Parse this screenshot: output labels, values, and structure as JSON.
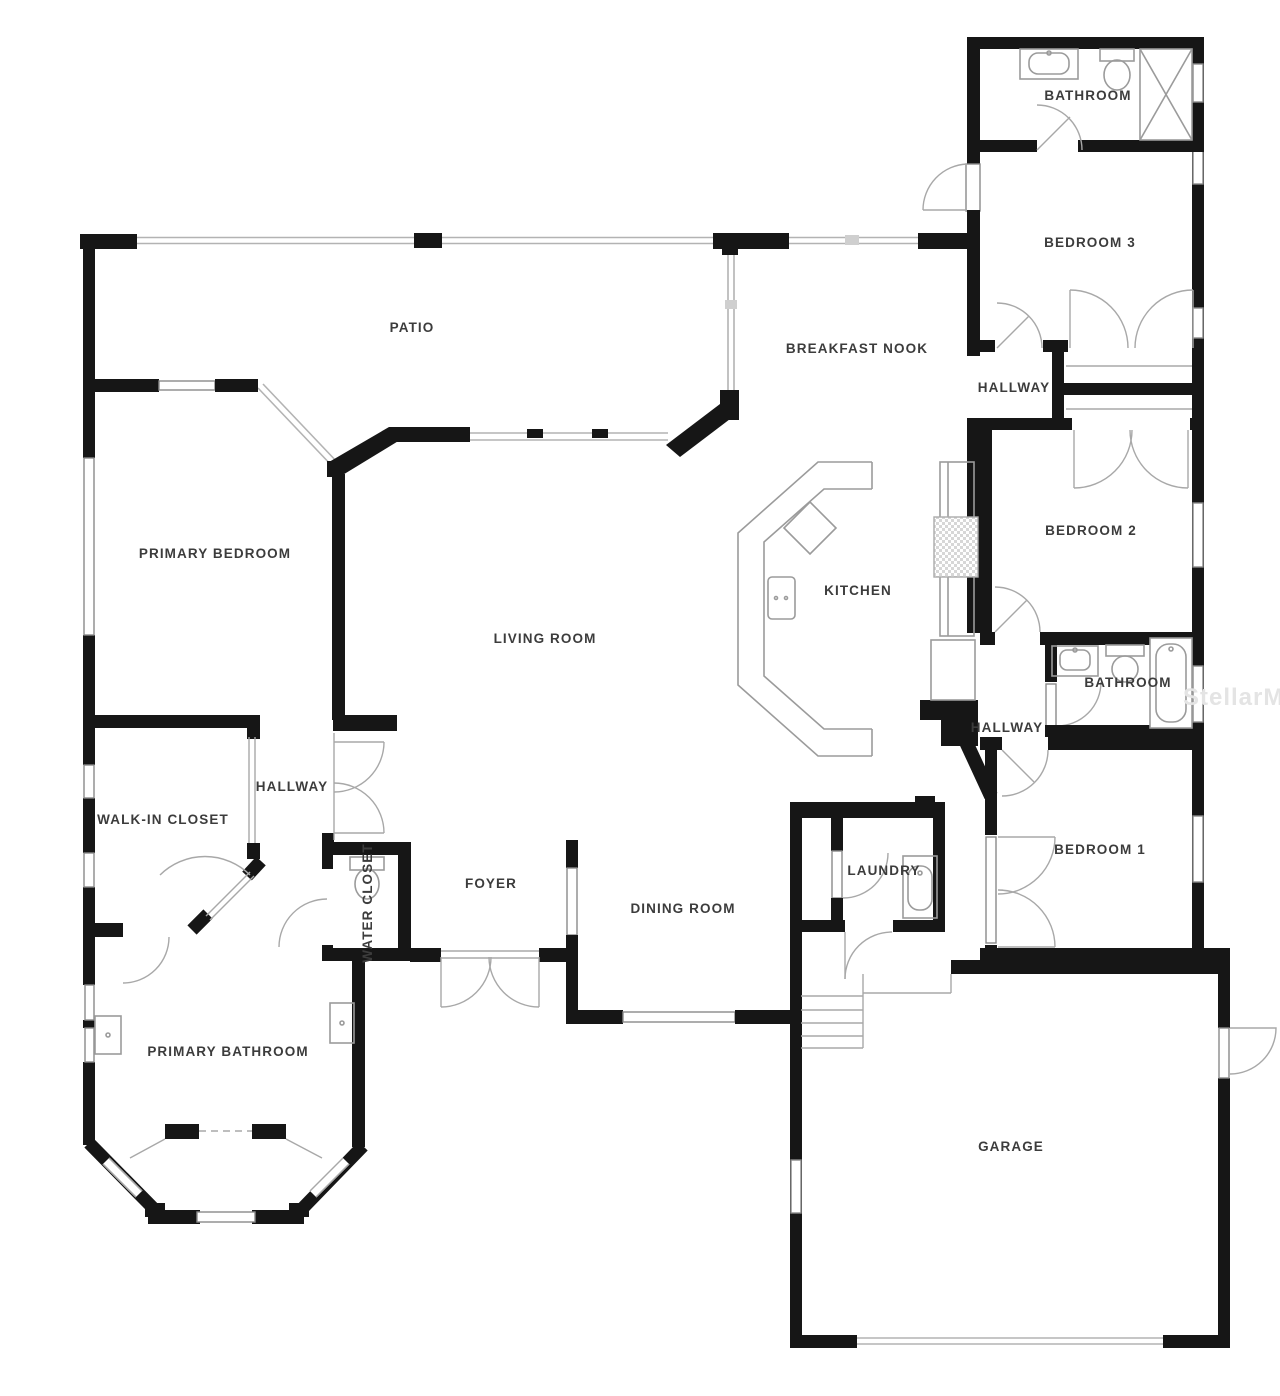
{
  "watermark": "StellarMLS",
  "colors": {
    "wall": "#161616",
    "fixture_line": "#9b9b9b",
    "screen_line": "#b3b3b3",
    "label_text": "#3c3c3c",
    "watermark_text": "#e4e4e4",
    "background": "#ffffff"
  },
  "rooms": {
    "patio": "PATIO",
    "breakfast_nook": "BREAKFAST NOOK",
    "bathroom_top": "BATHROOM",
    "bedroom3": "BEDROOM 3",
    "hallway_upper": "HALLWAY",
    "bedroom2": "BEDROOM 2",
    "bathroom_right": "BATHROOM",
    "hallway_lower": "HALLWAY",
    "bedroom1": "BEDROOM 1",
    "primary_bedroom": "PRIMARY BEDROOM",
    "living_room": "LIVING ROOM",
    "kitchen": "KITCHEN",
    "walk_in_closet": "WALK-IN CLOSET",
    "hallway_primary": "HALLWAY",
    "water_closet": "WATER CLOSET",
    "foyer": "FOYER",
    "dining_room": "DINING ROOM",
    "laundry": "LAUNDRY",
    "primary_bathroom": "PRIMARY BATHROOM",
    "garage": "GARAGE"
  }
}
